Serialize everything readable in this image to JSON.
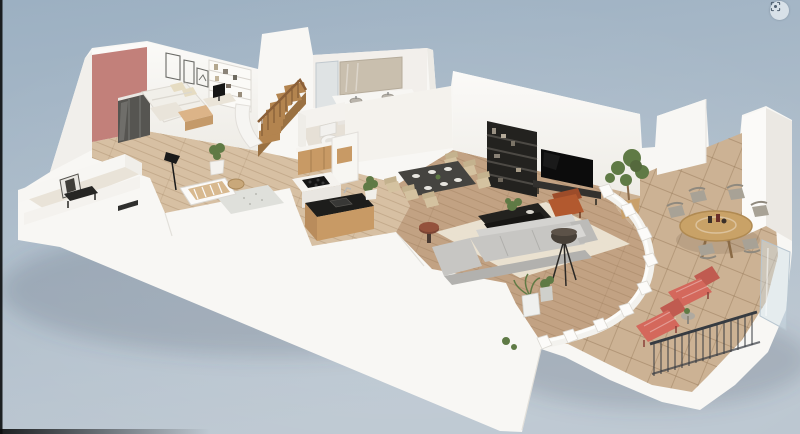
{
  "ui": {
    "recenter_button": {
      "icon": "focus-target-icon"
    }
  },
  "colors": {
    "background_top": "#9cb0c2",
    "background_bottom": "#bcc7d1",
    "frame_edge": "#0b0d0e",
    "wall_white": "#f8f7f4",
    "accent_wall_pink": "#c2807a",
    "wood_floor_light": "#d7c0a3",
    "wood_floor_mid": "#c2a283",
    "terrace_tile": "#ccb294",
    "kitchen_wood": "#c89a65",
    "stair_wood": "#b3844f",
    "dark_furniture": "#23221f",
    "sofa_gray": "#c7c6c3",
    "rug_beige": "#ebe4d3",
    "dining_chair_beige": "#d4c2a0",
    "armchair_rust": "#b2592f",
    "lounge_chair_coral": "#d4685c",
    "outdoor_chair_taupe": "#a8a296",
    "plant_green": "#5f7a45",
    "railing_dark": "#363b41",
    "glass_blue": "#cfdde6"
  },
  "scene": {
    "type": "3d-floor-plan-render",
    "view": "isometric-cutaway",
    "rooms": [
      {
        "name": "bedroom",
        "furniture": [
          "double-bed",
          "wall-frames",
          "bookshelf",
          "desk",
          "wardrobe",
          "storage-chest"
        ]
      },
      {
        "name": "staircase",
        "furniture": [
          "wooden-winder-stairs"
        ]
      },
      {
        "name": "bathroom",
        "furniture": [
          "double-vanity",
          "mirror",
          "shower"
        ]
      },
      {
        "name": "wc",
        "furniture": [
          "toilet"
        ]
      },
      {
        "name": "nursery",
        "furniture": [
          "crib",
          "rug",
          "floor-lamp",
          "basket",
          "potted-plant"
        ]
      },
      {
        "name": "hallway",
        "furniture": [
          "potted-plant"
        ]
      },
      {
        "name": "entry",
        "furniture": [
          "console-table",
          "framed-picture"
        ]
      },
      {
        "name": "kitchen",
        "furniture": [
          "base-cabinets",
          "tall-cabinet",
          "island-cooktop",
          "bar-counter-sink"
        ]
      },
      {
        "name": "dining-area",
        "furniture": [
          "dark-dining-table",
          "six-beige-chairs",
          "pedestal-side-table"
        ]
      },
      {
        "name": "living-room",
        "furniture": [
          "sectional-sofa",
          "coffee-table",
          "tv",
          "media-shelf",
          "rust-armchair",
          "tripod-floor-lamp",
          "rug",
          "olive-tree"
        ]
      },
      {
        "name": "terrace",
        "furniture": [
          "round-wood-table",
          "six-outdoor-chairs",
          "two-coral-loungers",
          "side-table",
          "planters",
          "metal-railing",
          "glass-balustrade",
          "curved-parapet"
        ]
      }
    ]
  }
}
